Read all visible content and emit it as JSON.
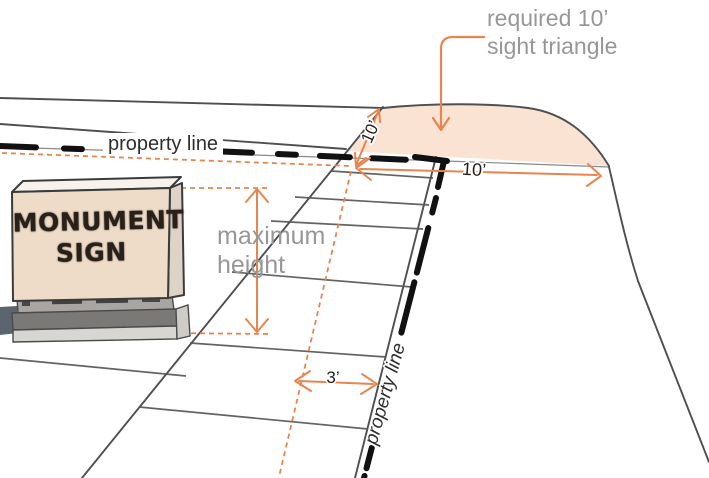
{
  "labels": {
    "sight_triangle": {
      "line1": "required 10’",
      "line2": "sight triangle"
    },
    "max_height": {
      "line1": "maximum",
      "line2": "height"
    },
    "property_line_top": "property line",
    "property_line_side": "property line",
    "sign": {
      "line1": "MONUMENT",
      "line2": "SIGN"
    },
    "dims": {
      "corner_up": "10’",
      "corner_right": "10’",
      "setback": "3’"
    }
  },
  "colors": {
    "accent": "#e8854f",
    "sight_fill": "#f8d8c0",
    "sign_face": "#eedbc8",
    "sign_side": "#ded3c7",
    "sign_top": "#f7f3ec",
    "line": "#4f4f4f",
    "label_gray": "#979797",
    "dark_text": "#2e2e2e",
    "dash_black": "#111111",
    "base_dark": "#7b7977",
    "base_mid": "#a8a5a2",
    "base_light": "#d8d6d3",
    "wall": "#5c6470"
  }
}
